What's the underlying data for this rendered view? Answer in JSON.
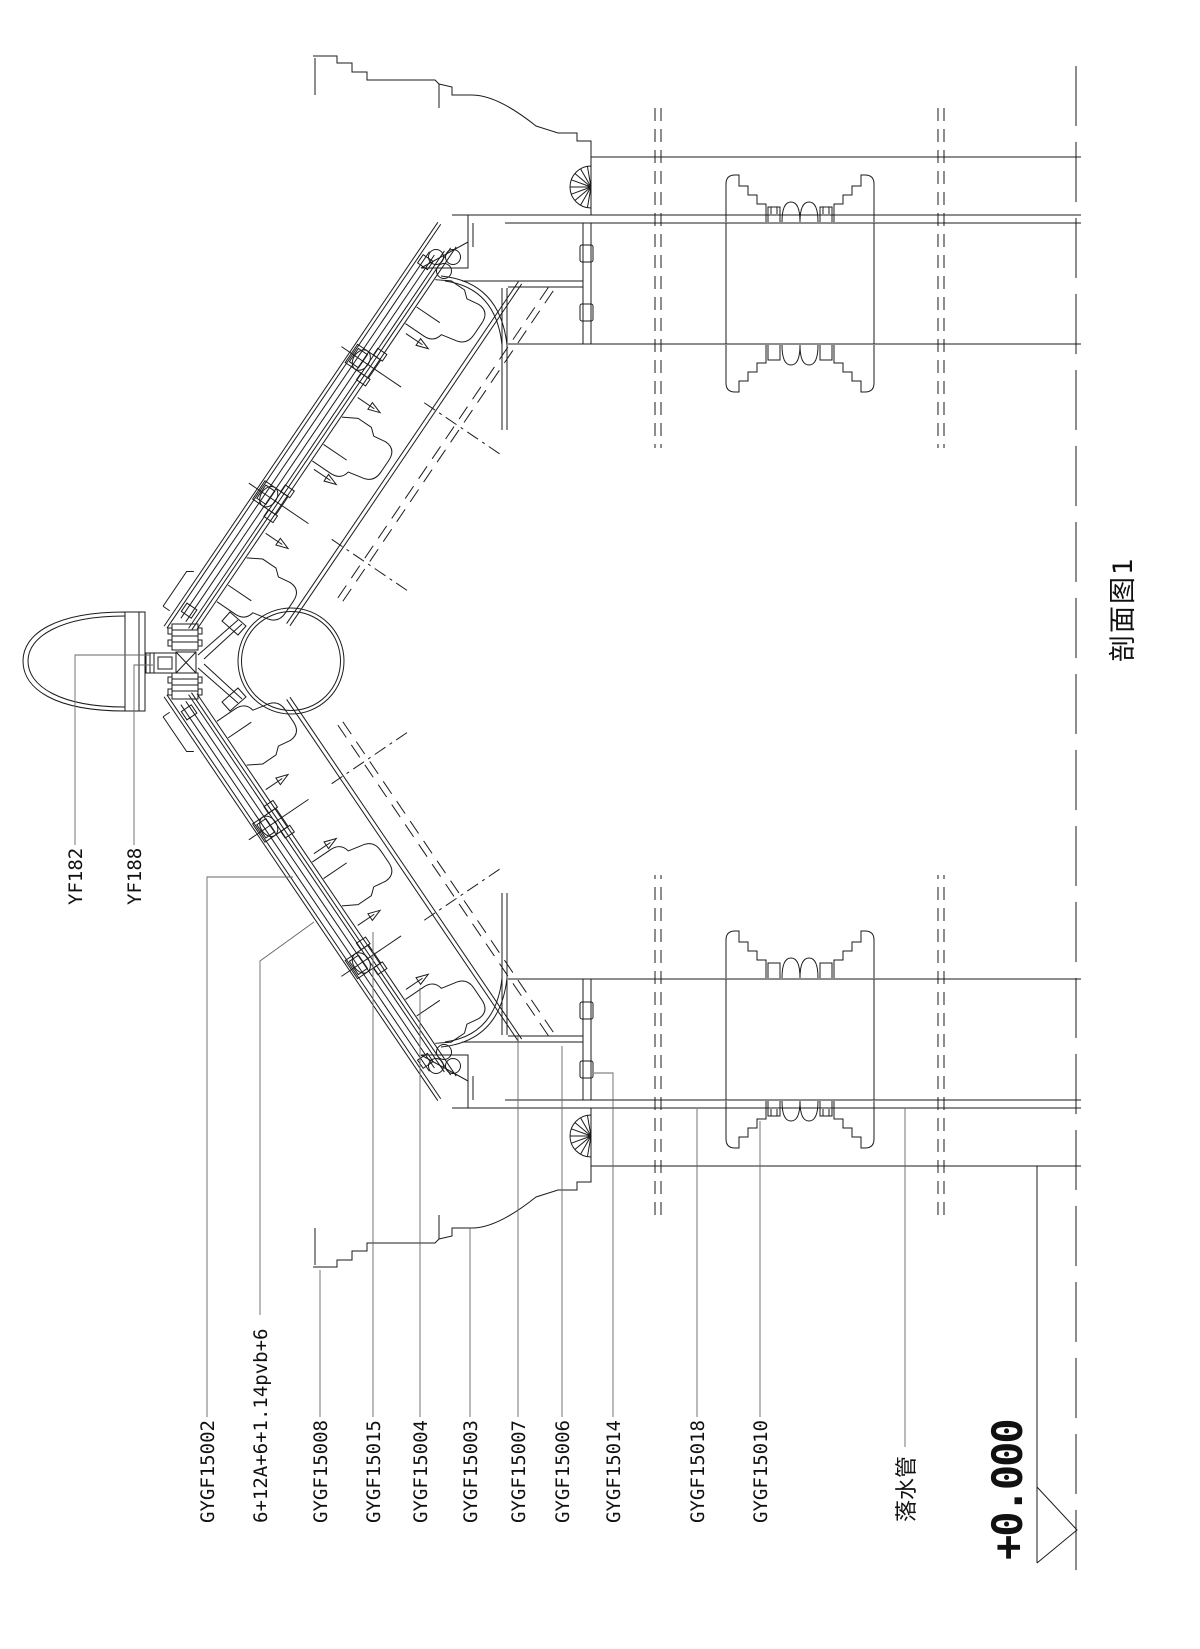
{
  "drawing": {
    "title": "剖面图1",
    "elevation_marker": "+0.000",
    "downpipe_label": "落水管",
    "ridge_labels": [
      {
        "text": "YF182"
      },
      {
        "text": "YF188"
      }
    ],
    "part_labels": [
      {
        "text": "GYGF15002"
      },
      {
        "text": "6+12A+6+1.14pvb+6"
      },
      {
        "text": "GYGF15008"
      },
      {
        "text": "GYGF15015"
      },
      {
        "text": "GYGF15004"
      },
      {
        "text": "GYGF15003"
      },
      {
        "text": "GYGF15007"
      },
      {
        "text": "GYGF15006"
      },
      {
        "text": "GYGF15014"
      },
      {
        "text": "GYGF15018"
      },
      {
        "text": "GYGF15010"
      }
    ],
    "colors": {
      "line": "#1b1b1b",
      "leader": "#666666",
      "fill_light": "#e6e6e6",
      "fill_mid": "#b5b5b5",
      "fill_dark": "#3a3a3a",
      "background": "#ffffff"
    }
  }
}
